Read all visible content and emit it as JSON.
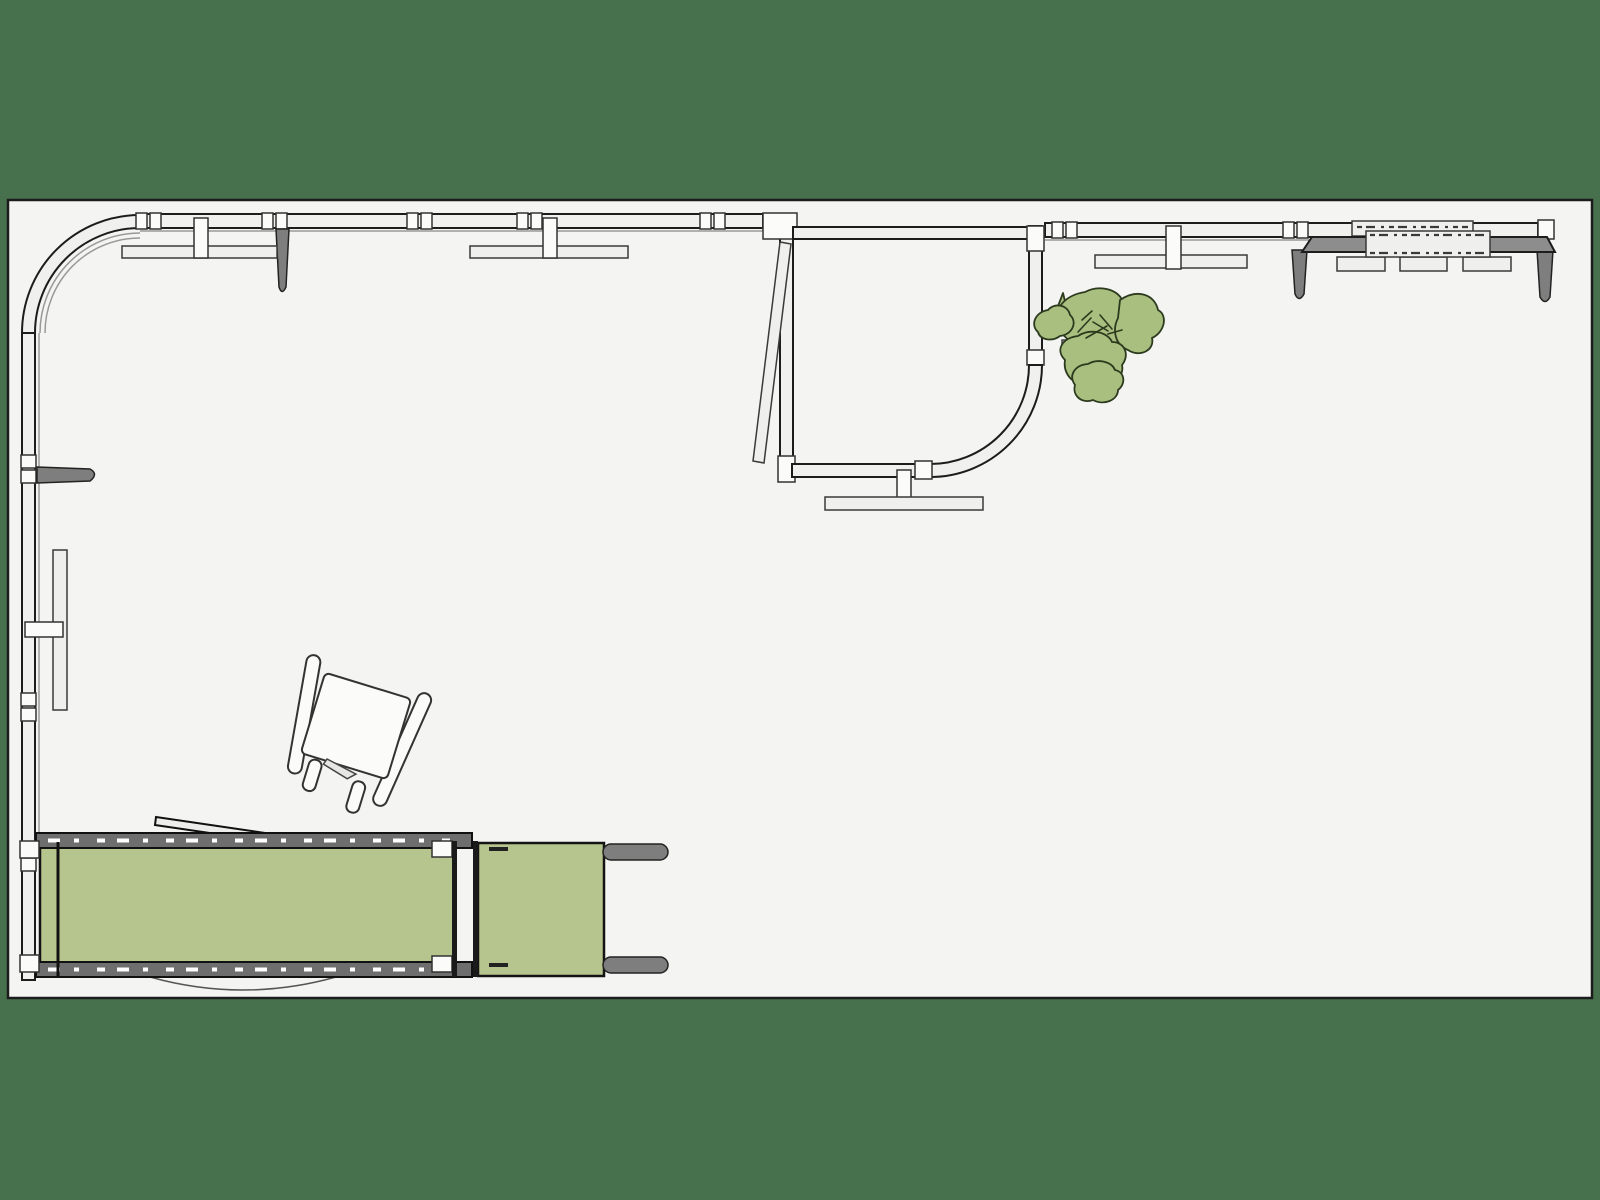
{
  "meta": {
    "app": "3d-floor-plan-top-view",
    "description": "Top-down parallel-projection view of a studio room floor plan on a dark green canvas; glazed walls with mullions, curved corner pod room with open door, desk, shelves, lounge chair, green daybed and a potted plant.",
    "canvas": {
      "width": 1600,
      "height": 1200
    }
  },
  "colors": {
    "bg": "#47704d",
    "floor": "#f4f4f2",
    "wall-fill": "#f0f0ee",
    "wall-stroke": "#1c1c1c",
    "block-fill": "#fbfbfa",
    "furn-light": "#efefed",
    "metal": "#7e7e7e",
    "desk-gray": "#8d8d8d",
    "rail-gray": "#6e6e6e",
    "cushion": "#b6c58d",
    "plant": "#a9bf7f",
    "plant-stroke": "#2c3a1e",
    "line-soft": "#999999",
    "white": "#ffffff"
  },
  "objects": [
    {
      "name": "floor",
      "type": "room floor slab",
      "approx_px": {
        "x": 8,
        "y": 200,
        "w": 1584,
        "h": 798
      }
    },
    {
      "name": "top-glazed-wall",
      "type": "glazed wall with mullion pairs",
      "runs": "x140-x763 and x1045-x1552"
    },
    {
      "name": "curved-corner-wall",
      "type": "quarter-circle glazed corner",
      "corner": "top-left"
    },
    {
      "name": "left-glazed-wall",
      "type": "glazed wall with mullion pairs",
      "runs": "y333-y980"
    },
    {
      "name": "wall-shelf-a",
      "type": "wall-mounted shelf with post and dark tapered leg",
      "approx_px": {
        "x": 122,
        "y": 246
      }
    },
    {
      "name": "wall-shelf-b",
      "type": "wall-mounted shelf with post",
      "approx_px": {
        "x": 470,
        "y": 246
      }
    },
    {
      "name": "wall-shelf-c",
      "type": "wall-mounted shelf with post",
      "approx_px": {
        "x": 1095,
        "y": 256
      }
    },
    {
      "name": "pod-room",
      "type": "enclosed interior room with curved corner and open door leaf",
      "approx_px": {
        "x": 780,
        "y": 215,
        "w": 265,
        "h": 265
      }
    },
    {
      "name": "pod-bench",
      "type": "bench/table below pod wall",
      "approx_px": {
        "x": 825,
        "y": 497
      }
    },
    {
      "name": "desk",
      "type": "desk with dark top, tray, three drawers, two tapered legs",
      "approx_px": {
        "x": 1290,
        "y": 221
      }
    },
    {
      "name": "desk-wall-shelf",
      "type": "slim shelf/monitor on wall above desk",
      "approx_px": {
        "x": 1352,
        "y": 221
      }
    },
    {
      "name": "plant",
      "type": "potted leafy plant, top view",
      "approx_px": {
        "x": 1035,
        "y": 290
      }
    },
    {
      "name": "lounge-chair",
      "type": "armchair rotated ~17 degrees",
      "approx_px": {
        "x": 300,
        "y": 655
      }
    },
    {
      "name": "daybed",
      "type": "green daybed: cushions, dashed rails, end caps, gray arm bars, round side arc",
      "approx_px": {
        "x": 20,
        "y": 817,
        "w": 650,
        "h": 185
      }
    },
    {
      "name": "left-wall-bracket",
      "type": "dark tapered wall bracket",
      "approx_px": {
        "x": 37,
        "y": 466
      }
    },
    {
      "name": "left-wall-shelf",
      "type": "vertical wall shelf with post",
      "approx_px": {
        "x": 53,
        "y": 550
      }
    }
  ]
}
